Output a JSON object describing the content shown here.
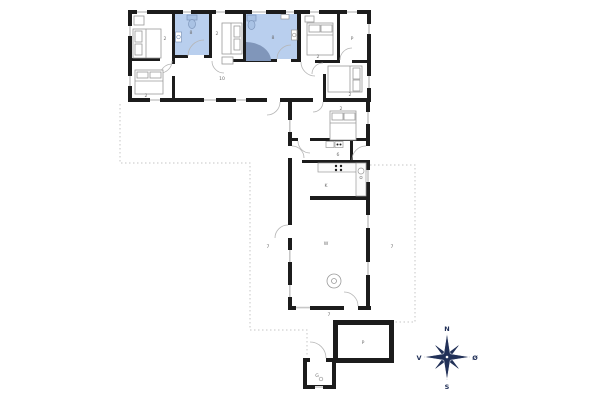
{
  "title": "floor-plan",
  "colors": {
    "wall": "#1c1c1c",
    "bathroom_highlight": "#b9cfee",
    "bathtub": "#8096ba",
    "fixture_blue": "#a9c2e4",
    "compass": "#223158",
    "window_line": "#c8c8c8",
    "dashed_terrace": "#c6c6c6",
    "label_text": "#6e6e6e"
  },
  "compass": {
    "north": "N",
    "south": "S",
    "west": "V",
    "east": "Ø"
  },
  "rooms": [
    {
      "name": "bedroom-nw",
      "label": "2"
    },
    {
      "name": "bathroom-small",
      "label": "8"
    },
    {
      "name": "bedroom-sw",
      "label": "2"
    },
    {
      "name": "bedroom-n",
      "label": "2"
    },
    {
      "name": "bathroom-large",
      "label": "8"
    },
    {
      "name": "hallway",
      "label": "10"
    },
    {
      "name": "bedroom-ne",
      "label": "2"
    },
    {
      "name": "storage",
      "label": "P"
    },
    {
      "name": "bedroom-se",
      "label": "2"
    },
    {
      "name": "bedroom-mid",
      "label": "2"
    },
    {
      "name": "entry",
      "label": "6"
    },
    {
      "name": "kitchen",
      "label": "K"
    },
    {
      "name": "living-room",
      "label": "W"
    },
    {
      "name": "terrace-west",
      "label": "7"
    },
    {
      "name": "terrace-east",
      "label": "7"
    },
    {
      "name": "terrace-south",
      "label": "7"
    },
    {
      "name": "carport",
      "label": "P"
    },
    {
      "name": "shed",
      "label": "G"
    }
  ]
}
